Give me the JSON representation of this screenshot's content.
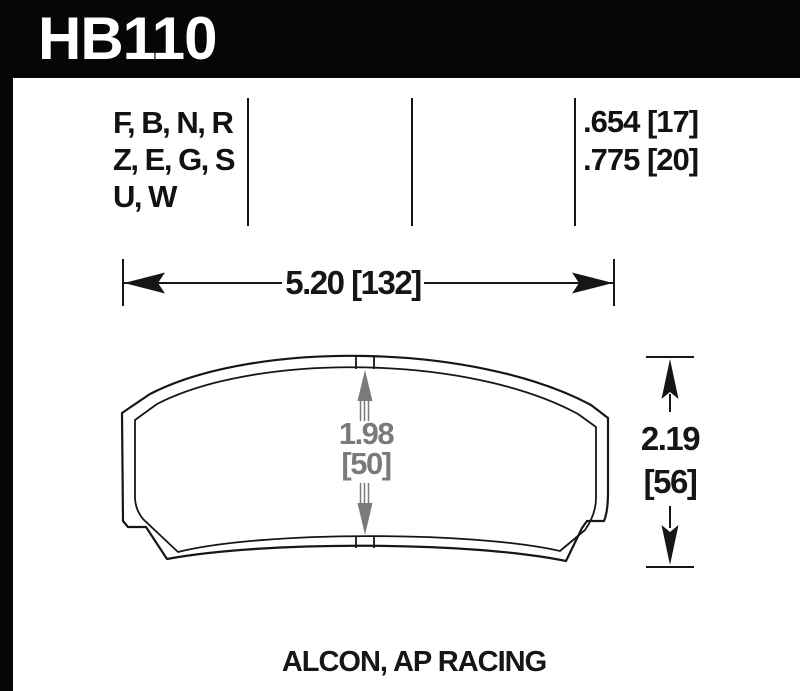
{
  "header": {
    "part_number": "HB110"
  },
  "spec_table": {
    "compound_lines": [
      "F, B, N, R",
      "Z, E, G, S",
      "U, W"
    ],
    "thickness_lines": [
      ".654 [17]",
      ".775 [20]"
    ]
  },
  "dimensions": {
    "pad_width": {
      "label": "5.20 [132]"
    },
    "friction_height": {
      "inches": "1.98",
      "millimeters": "[50]"
    },
    "overall_height": {
      "inches": "2.19",
      "millimeters": "[56]"
    }
  },
  "footer": {
    "applications": "ALCON, AP RACING"
  },
  "colors": {
    "bar_black": "#060606",
    "ink": "#161616",
    "dim_gray": "#7a7a7a",
    "paper": "#ffffff"
  }
}
